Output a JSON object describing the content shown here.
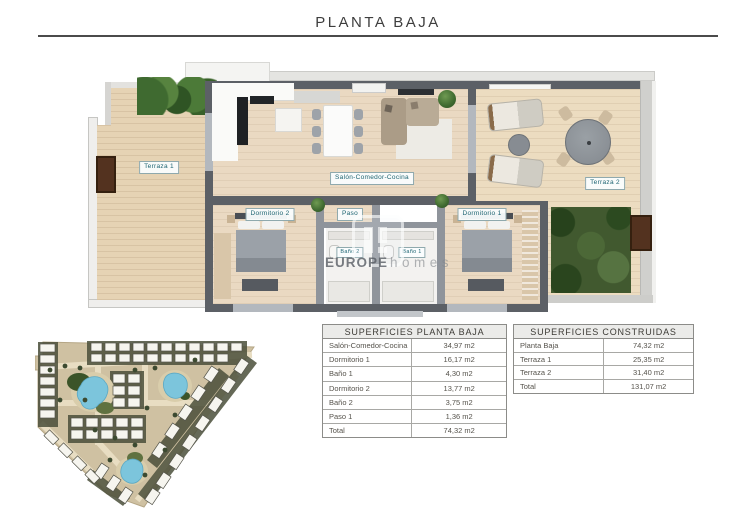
{
  "title": "PLANTA BAJA",
  "floor_plan": {
    "labels": {
      "terraza_1": "Terraza 1",
      "terraza_2": "Terraza 2",
      "salon": "Salón-Comedor-Cocina",
      "dormitorio_2": "Dormitorio 2",
      "dormitorio_1": "Dormitorio 1",
      "paso": "Paso",
      "bano_2": "Baño 2",
      "bano_1": "Baño 1"
    },
    "watermark": {
      "bold": "EUROPE",
      "light": "homes"
    }
  },
  "tables": {
    "superficies_planta_baja": {
      "title": "SUPERFICIES PLANTA BAJA",
      "rows": [
        {
          "label": "Salón-Comedor-Cocina",
          "value": "34,97 m2"
        },
        {
          "label": "Dormitorio 1",
          "value": "16,17 m2"
        },
        {
          "label": "Baño 1",
          "value": "4,30 m2"
        },
        {
          "label": "Dormitorio 2",
          "value": "13,77 m2"
        },
        {
          "label": "Baño 2",
          "value": "3,75 m2"
        },
        {
          "label": "Paso 1",
          "value": "1,36 m2"
        },
        {
          "label": "Total",
          "value": "74,32 m2"
        }
      ]
    },
    "superficies_construidas": {
      "title": "SUPERFICIES CONSTRUIDAS",
      "rows": [
        {
          "label": "Planta Baja",
          "value": "74,32 m2"
        },
        {
          "label": "Terraza 1",
          "value": "25,35 m2"
        },
        {
          "label": "Terraza 2",
          "value": "31,40 m2"
        },
        {
          "label": "Total",
          "value": "131,07 m2"
        }
      ]
    }
  },
  "colors": {
    "label_text_teal": "#1d6472",
    "wall_dark": "#5c6066",
    "floor_wood": "#ead9c2",
    "pool_blue": "#7cc5dc",
    "grass_green": "#41592f",
    "door_brown": "#53321f",
    "table_border": "#8c8c89"
  }
}
